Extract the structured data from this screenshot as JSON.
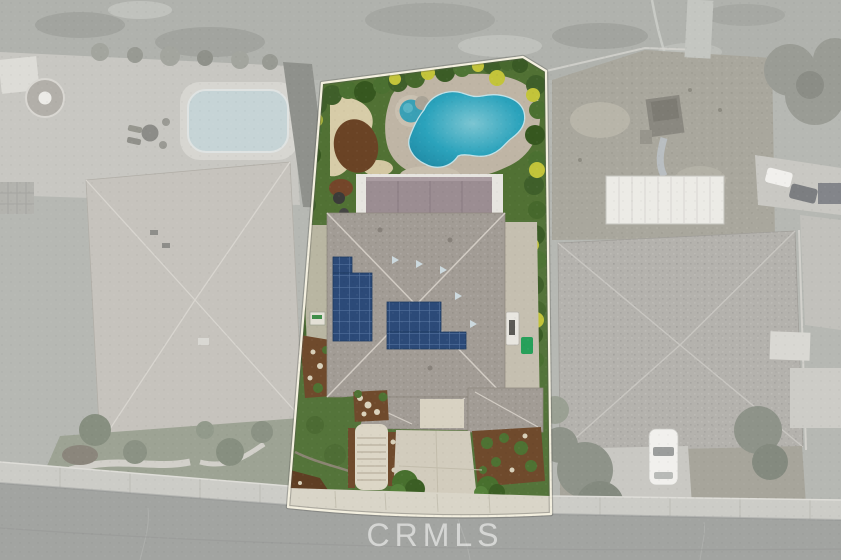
{
  "watermark": {
    "text": "CRMLS"
  },
  "colors": {
    "background_desaturated": "#b6b8b3",
    "street": "#a2a4a1",
    "sidewalk": "#ccccc7",
    "lot_boundary": "#f4f0e0",
    "lawn": "#54743a",
    "backyard_green": "#517134",
    "pool_water": "#2ba3bc",
    "pool_water_light": "#7cc5d2",
    "pool_water_dark": "#1e87a2",
    "spa_water": "#3aa0b5",
    "roof": "#a29c95",
    "patio_cover": "#9b8d92",
    "solar_panel": "#2c4a78",
    "solar_grid": "#5b7aa6",
    "mulch": "#6f4a2c",
    "driveway": "#d2ccbd",
    "palm_yellow": "#c3c43a",
    "trash_bin_green": "#27a05a",
    "car_white": "#f1f0ed",
    "watermark_color": "rgba(255,255,255,0.55)"
  },
  "scene": {
    "description": "Aerial drone photo of a residential lot shown in full color while all surrounding properties are desaturated gray; CRMLS watermark on the street at bottom.",
    "subject_lot": {
      "label": "highlighted-property",
      "features": [
        "free-form swimming pool",
        "round spa",
        "stone pool deck",
        "tropical landscaping with yellow palms",
        "sand path",
        "mulch beds",
        "covered patio with mauve roof",
        "gray hip-roof house",
        "rooftop solar array left",
        "rooftop solar array center",
        "side yard with equipment and green bin",
        "front lawn",
        "curved entry steps",
        "planter beds",
        "concrete driveway",
        "street trees",
        "sidewalk"
      ]
    },
    "left_neighbor": {
      "features": [
        "gazebo",
        "swimming pool",
        "patio furniture",
        "large hip-roof house",
        "front lawn with curved walkways"
      ]
    },
    "right_neighbor": {
      "features": [
        "dirt backyard",
        "play structure with slide",
        "white patio cover",
        "hip-roof house",
        "driveway with white car",
        "trees"
      ]
    },
    "street": {
      "location": "bottom edge, running diagonally with sidewalk and curb"
    }
  }
}
